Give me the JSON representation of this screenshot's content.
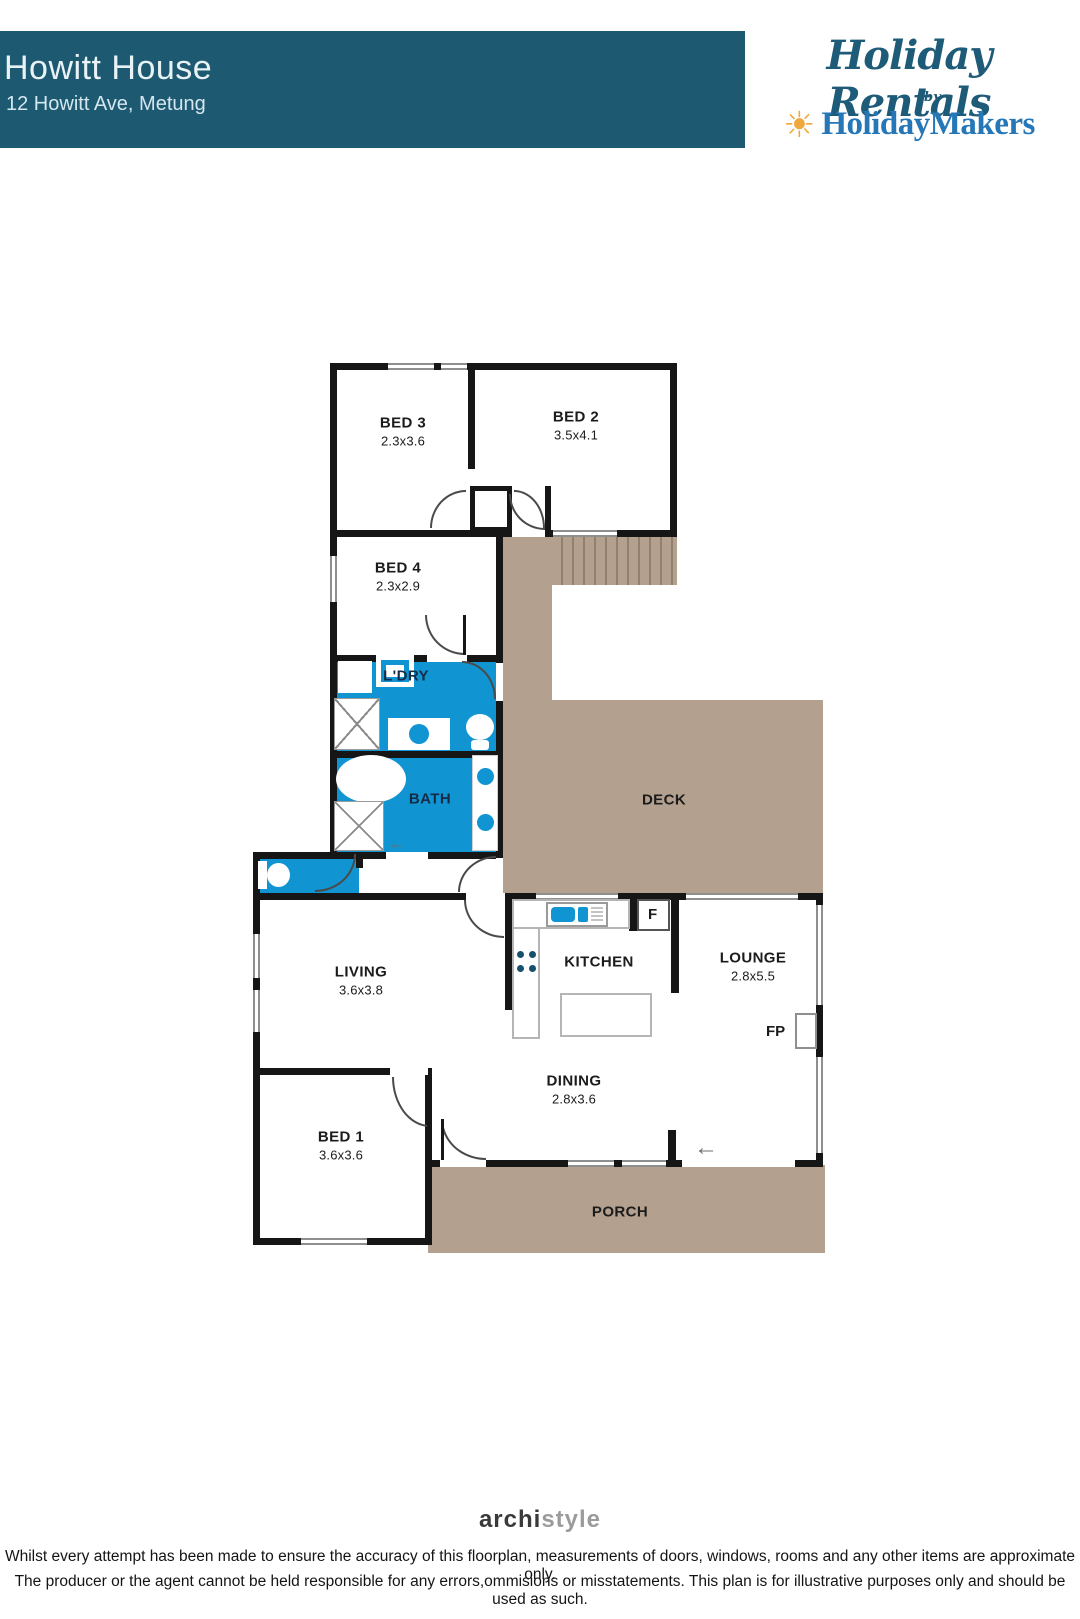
{
  "header": {
    "title": "Howitt House",
    "address": "12 Howitt Ave, Metung"
  },
  "logo": {
    "script": "Holiday Rentals",
    "by": "by",
    "brand": "HolidayMakers",
    "sun_icon": "sun-icon",
    "colors": {
      "script_teal": "#1e5b78",
      "brand_blue": "#2577b7",
      "sun_orange": "#f0a73c"
    }
  },
  "floorplan": {
    "rooms": {
      "bed3": {
        "label": "BED 3",
        "dims": "2.3x3.6"
      },
      "bed2": {
        "label": "BED 2",
        "dims": "3.5x4.1"
      },
      "bed4": {
        "label": "BED 4",
        "dims": "2.3x2.9"
      },
      "laundry": {
        "label": "L'DRY"
      },
      "bath": {
        "label": "BATH"
      },
      "deck": {
        "label": "DECK"
      },
      "living": {
        "label": "LIVING",
        "dims": "3.6x3.8"
      },
      "kitchen": {
        "label": "KITCHEN"
      },
      "lounge": {
        "label": "LOUNGE",
        "dims": "2.8x5.5"
      },
      "dining": {
        "label": "DINING",
        "dims": "2.8x3.6"
      },
      "bed1": {
        "label": "BED 1",
        "dims": "3.6x3.6"
      },
      "porch": {
        "label": "PORCH"
      }
    },
    "markers": {
      "fridge": "F",
      "fireplace": "FP"
    },
    "icons": {
      "slide_arrow": "←"
    },
    "colors": {
      "wet_area": "#1095d2",
      "deck_tan": "#b3a08e",
      "wall": "#161616",
      "header_teal": "#1d5971"
    }
  },
  "footer": {
    "brand_bold": "archi",
    "brand_light": "style",
    "disclaimer_1": "Whilst every attempt has been made to ensure the accuracy of this floorplan, measurements of doors, windows, rooms and any other items are approximate only.",
    "disclaimer_2": "The producer or the agent cannot be held responsible for any errors,ommisions or misstatements. This plan is for illustrative purposes only and should be used as such."
  }
}
